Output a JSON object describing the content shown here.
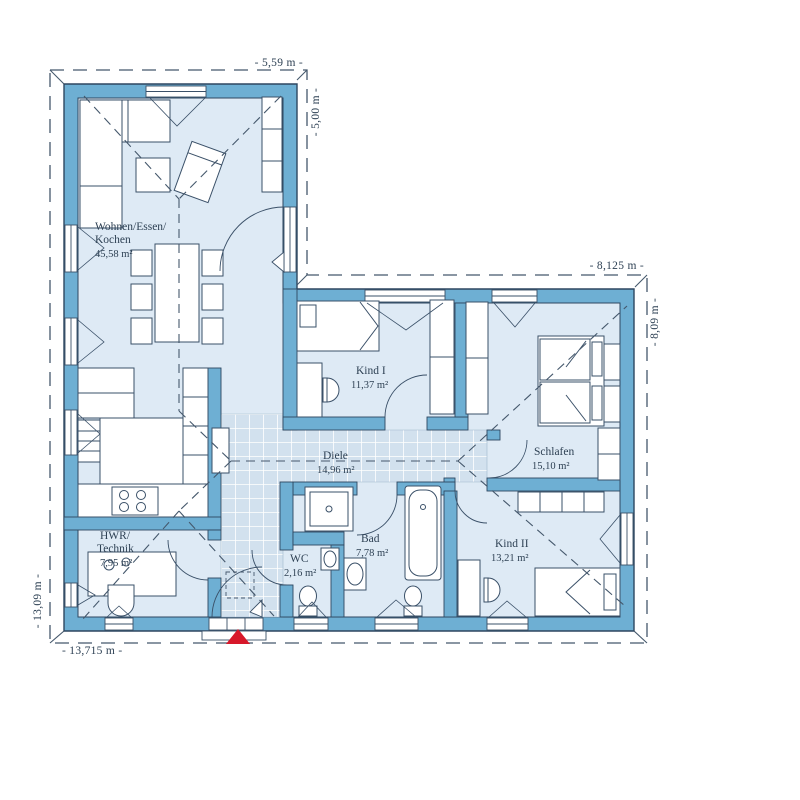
{
  "plan": {
    "title": "Bungalow floor plan",
    "rooms": [
      {
        "key": "wohnen",
        "lines": [
          "Wohnen/Essen/",
          "Kochen"
        ],
        "area": "45,58 m²"
      },
      {
        "key": "kind1",
        "lines": [
          "Kind I"
        ],
        "area": "11,37 m²"
      },
      {
        "key": "schlafen",
        "lines": [
          "Schlafen"
        ],
        "area": "15,10 m²"
      },
      {
        "key": "diele",
        "lines": [
          "Diele"
        ],
        "area": "14,96 m²"
      },
      {
        "key": "hwr",
        "lines": [
          "HWR/",
          "Technik"
        ],
        "area": "7,95 m²"
      },
      {
        "key": "wc",
        "lines": [
          "WC"
        ],
        "area": "2,16 m²"
      },
      {
        "key": "bad",
        "lines": [
          "Bad"
        ],
        "area": "7,78 m²"
      },
      {
        "key": "kind2",
        "lines": [
          "Kind II"
        ],
        "area": "13,21 m²"
      }
    ],
    "dimensions": {
      "top": "- 5,59 m -",
      "right_upper": "- 5,00 m -",
      "wing_top": "- 8,125 m -",
      "right_side": "- 8,09 m -",
      "left_side": "- 13,09 m -",
      "bottom": "- 13,715 m -"
    },
    "colors": {
      "wall": "#6EAFD3",
      "room": "#DEEAF5",
      "tile": "#D2E1EE",
      "outline": "#2E4760",
      "entrance_arrow": "#D7182A"
    }
  }
}
